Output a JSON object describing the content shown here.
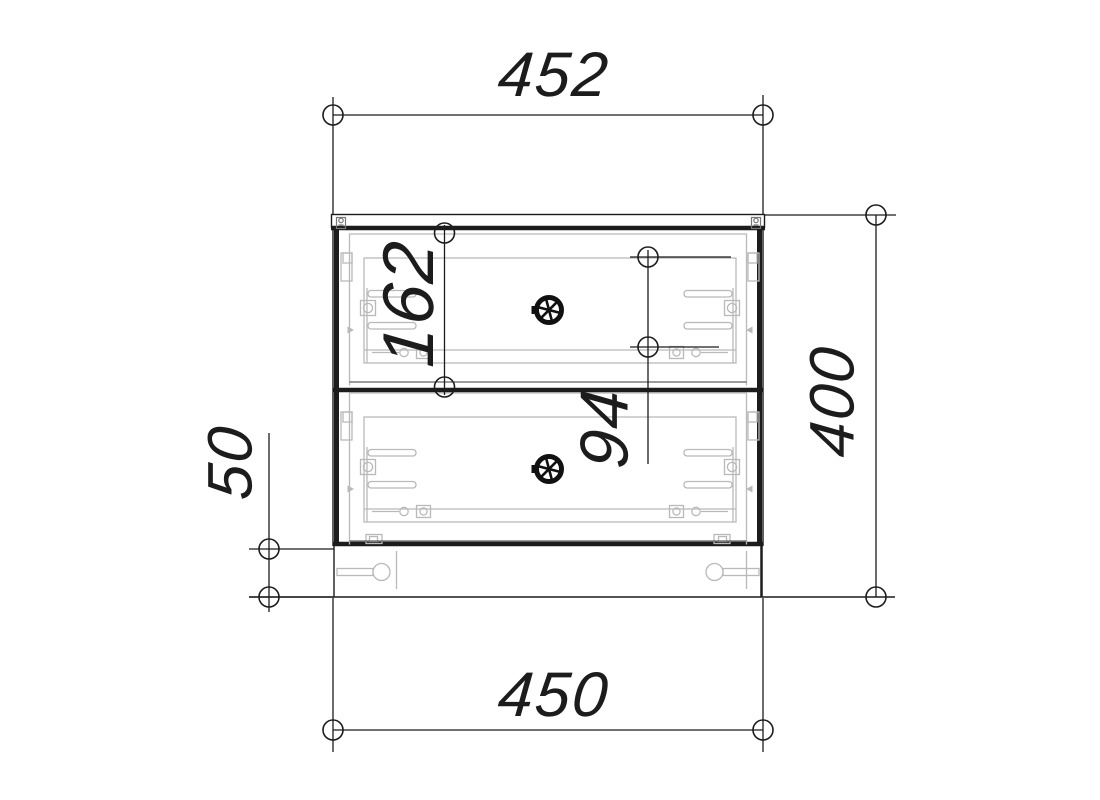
{
  "dimensions": {
    "top_width": "452",
    "bottom_width": "450",
    "overall_height": "400",
    "plinth_height": "50",
    "top_drawer_front_height": "162",
    "drawer_box_height": "94"
  },
  "colors": {
    "line": "#1c1c1c",
    "detail": "#b9b9b9",
    "knob": "#111111",
    "background": "#ffffff"
  },
  "icons": {
    "drawer_knob": "spoked-wheel-knob-icon"
  }
}
